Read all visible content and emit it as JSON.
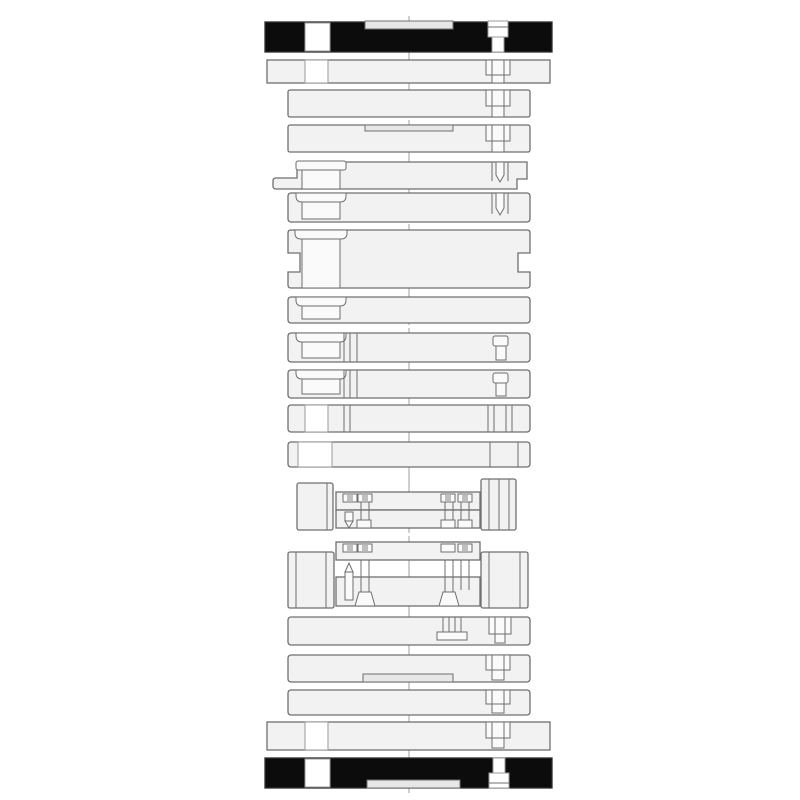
{
  "colors": {
    "background": "#ffffff",
    "plate_fill": "#f2f2f2",
    "hole_fill": "#fafafa",
    "recess_fill": "#e7e7e7",
    "hatch_fill": "#bfbfbf",
    "outline": "#6f6f6f",
    "outline_dark": "#2e2e2e",
    "black_fill": "#0c0c0c",
    "white": "#ffffff",
    "centerline": "#9f9f9f"
  },
  "diagram": {
    "type": "technical-drawing",
    "description": "Exploded sectional side view of a die / mold plate stack with centerline",
    "parts": [
      "top-clamping-plate",
      "upper-mounting-plate",
      "upper-spacer-plate",
      "upper-backing-plate",
      "punch-clamp-plate",
      "punch-backing-plate",
      "upper-die-shoe",
      "pad-plate-1",
      "pad-plate-2",
      "pad-plate-3",
      "retainer-plate-1",
      "retainer-plate-2",
      "left-upper-spacer-block",
      "right-upper-spacer-block",
      "upper-punch-unit",
      "left-lower-spacer-block",
      "right-lower-spacer-block",
      "lower-punch-unit",
      "stripper-plate",
      "die-plate",
      "lower-backing-plate",
      "lower-spacer-plate",
      "lower-mounting-plate",
      "bottom-clamping-plate"
    ]
  }
}
